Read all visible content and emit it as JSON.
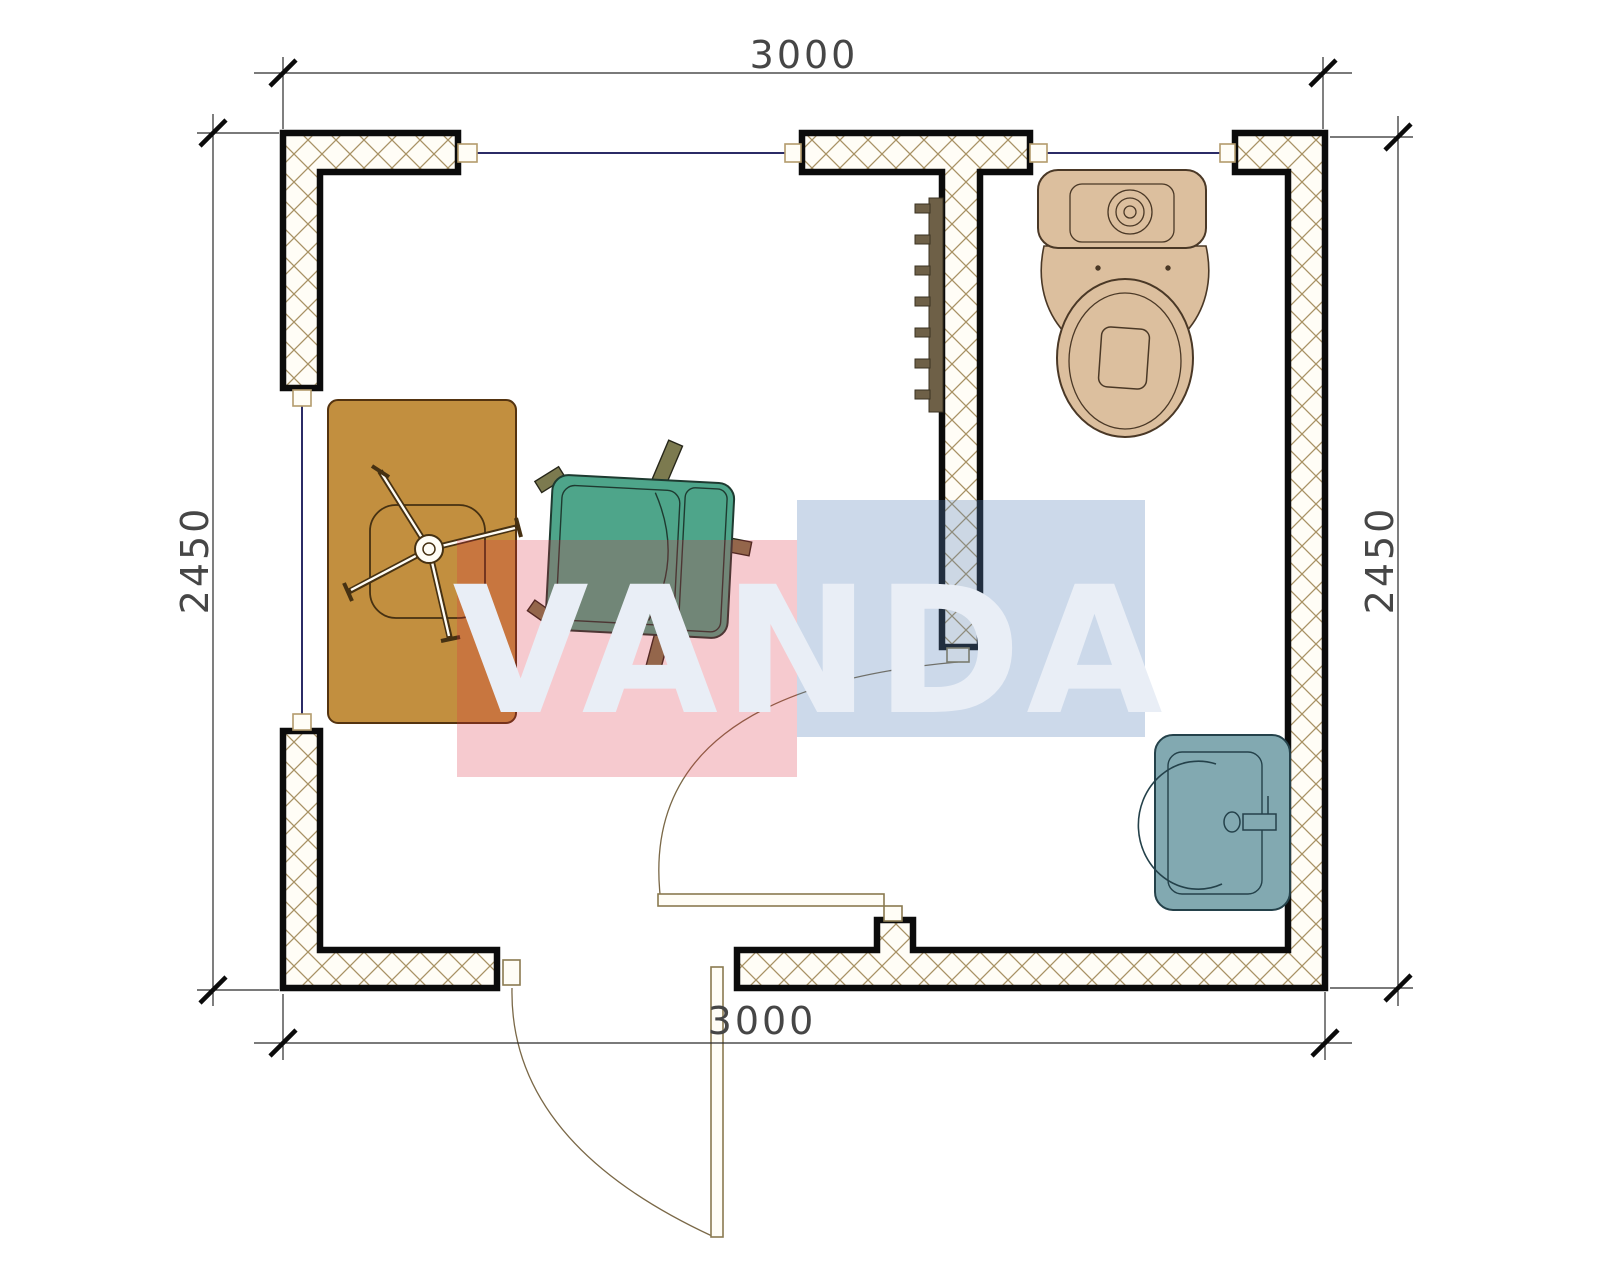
{
  "title": "cabin-floor-plan",
  "dimensions": {
    "top": "3000",
    "bottom": "3000",
    "left": "2450",
    "right": "2450"
  },
  "watermark": {
    "text": "VANDA",
    "red_block_color": "rgba(220,45,62,0.25)",
    "blue_block_color": "rgba(85,128,185,0.30)",
    "letter_color": "#e9eef6"
  },
  "colors": {
    "wall_outline": "#0b0b0b",
    "wall_hatch": "#a89264",
    "wall_fill": "#fffdf6",
    "window_glass": "#2b2b66",
    "frame_stroke": "#b39b6c",
    "door_leaf_stroke": "#8a7a50",
    "door_arc": "#7a6847",
    "desk": "#c28f3f",
    "armchair": "#4ea58a",
    "armchair_leg": "#7c7a4f",
    "toilet": "#dcbf9e",
    "sink": "#82a9b1",
    "radiator": "#6e6047",
    "dim_line": "#2a2a2a"
  }
}
